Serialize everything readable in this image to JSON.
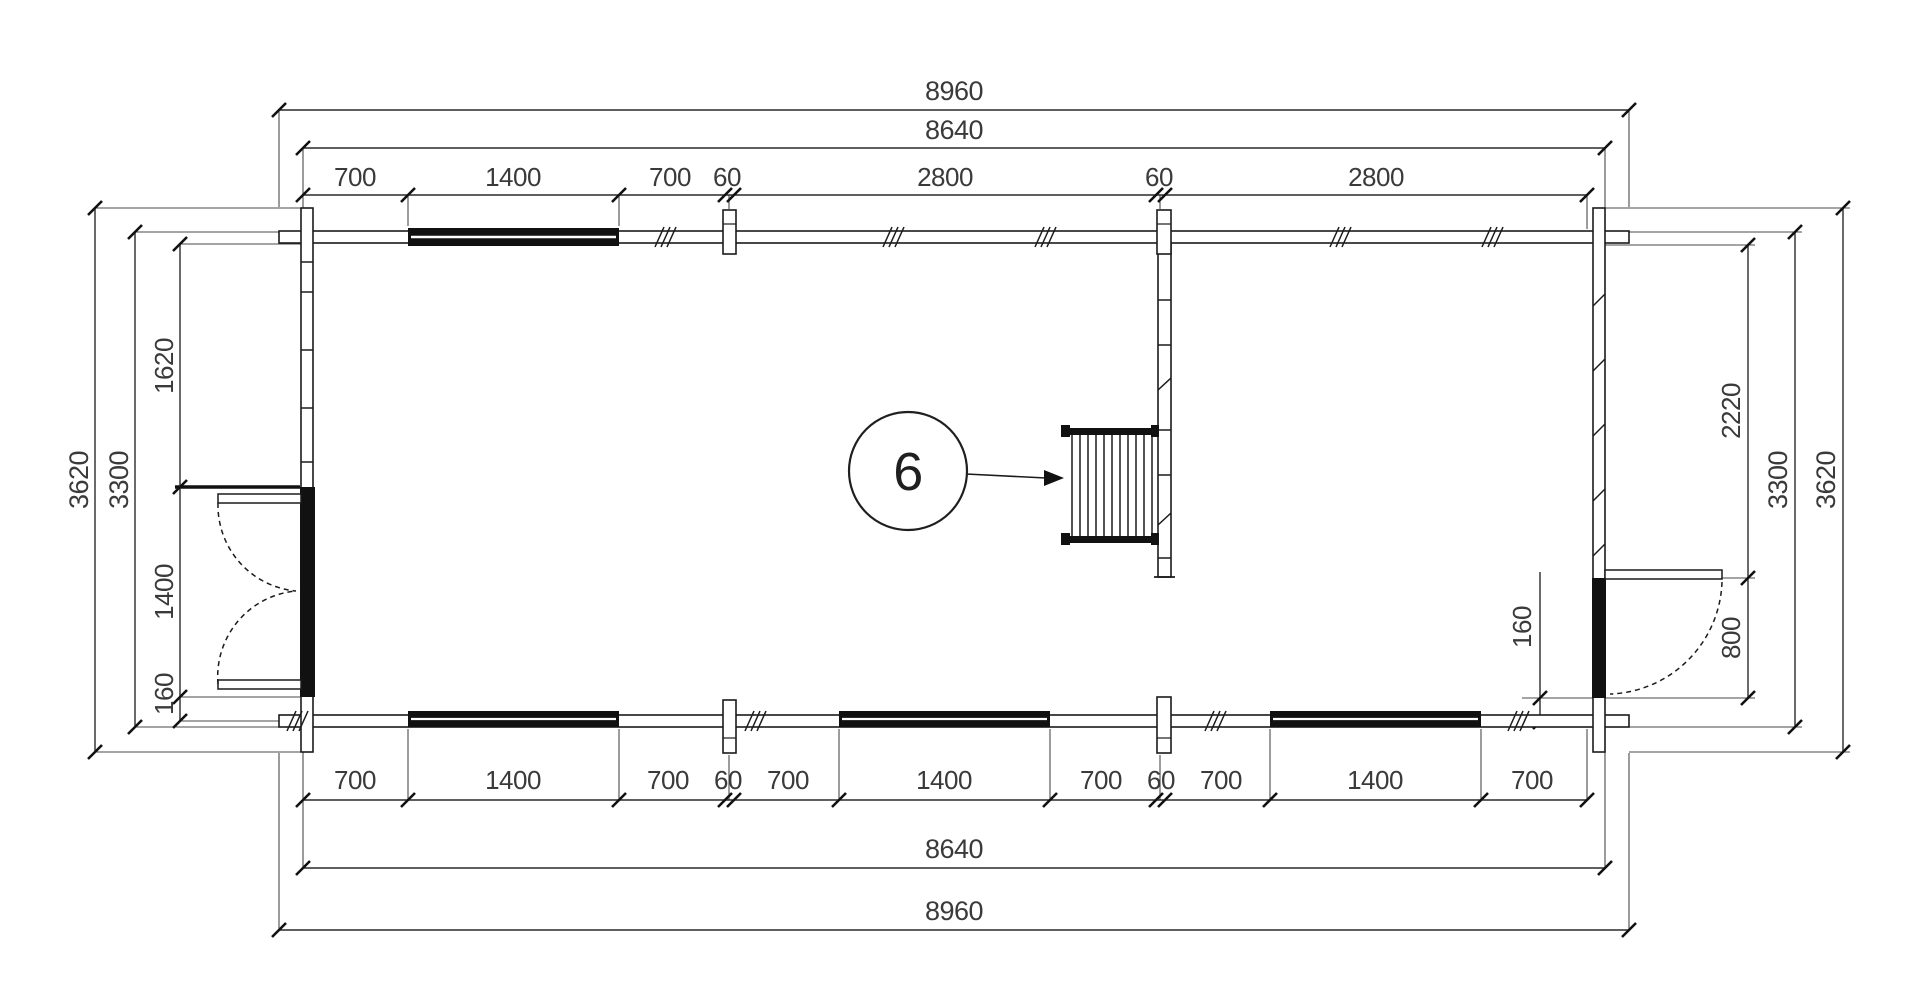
{
  "drawing": {
    "type": "floor-plan",
    "callout": {
      "number": "6"
    },
    "dims": {
      "top_overall": "8960",
      "top_shell": "8640",
      "top_chain": [
        "700",
        "1400",
        "700",
        "60",
        "2800",
        "60",
        "2800"
      ],
      "bottom_chain": [
        "700",
        "1400",
        "700",
        "60",
        "700",
        "1400",
        "700",
        "60",
        "700",
        "1400",
        "700"
      ],
      "bottom_shell": "8640",
      "bottom_overall": "8960",
      "left_overall": "3620",
      "left_shell": "3300",
      "left_chain": [
        "1620",
        "1400",
        "160"
      ],
      "right_chain": [
        "2220",
        "800"
      ],
      "right_shell": "3300",
      "right_overall": "3620",
      "right_inset": "160"
    },
    "colors": {
      "line": "#1b1b1b",
      "dim_line": "#2a2a2a",
      "text": "#3a3a3a",
      "fill": "#111111"
    }
  }
}
